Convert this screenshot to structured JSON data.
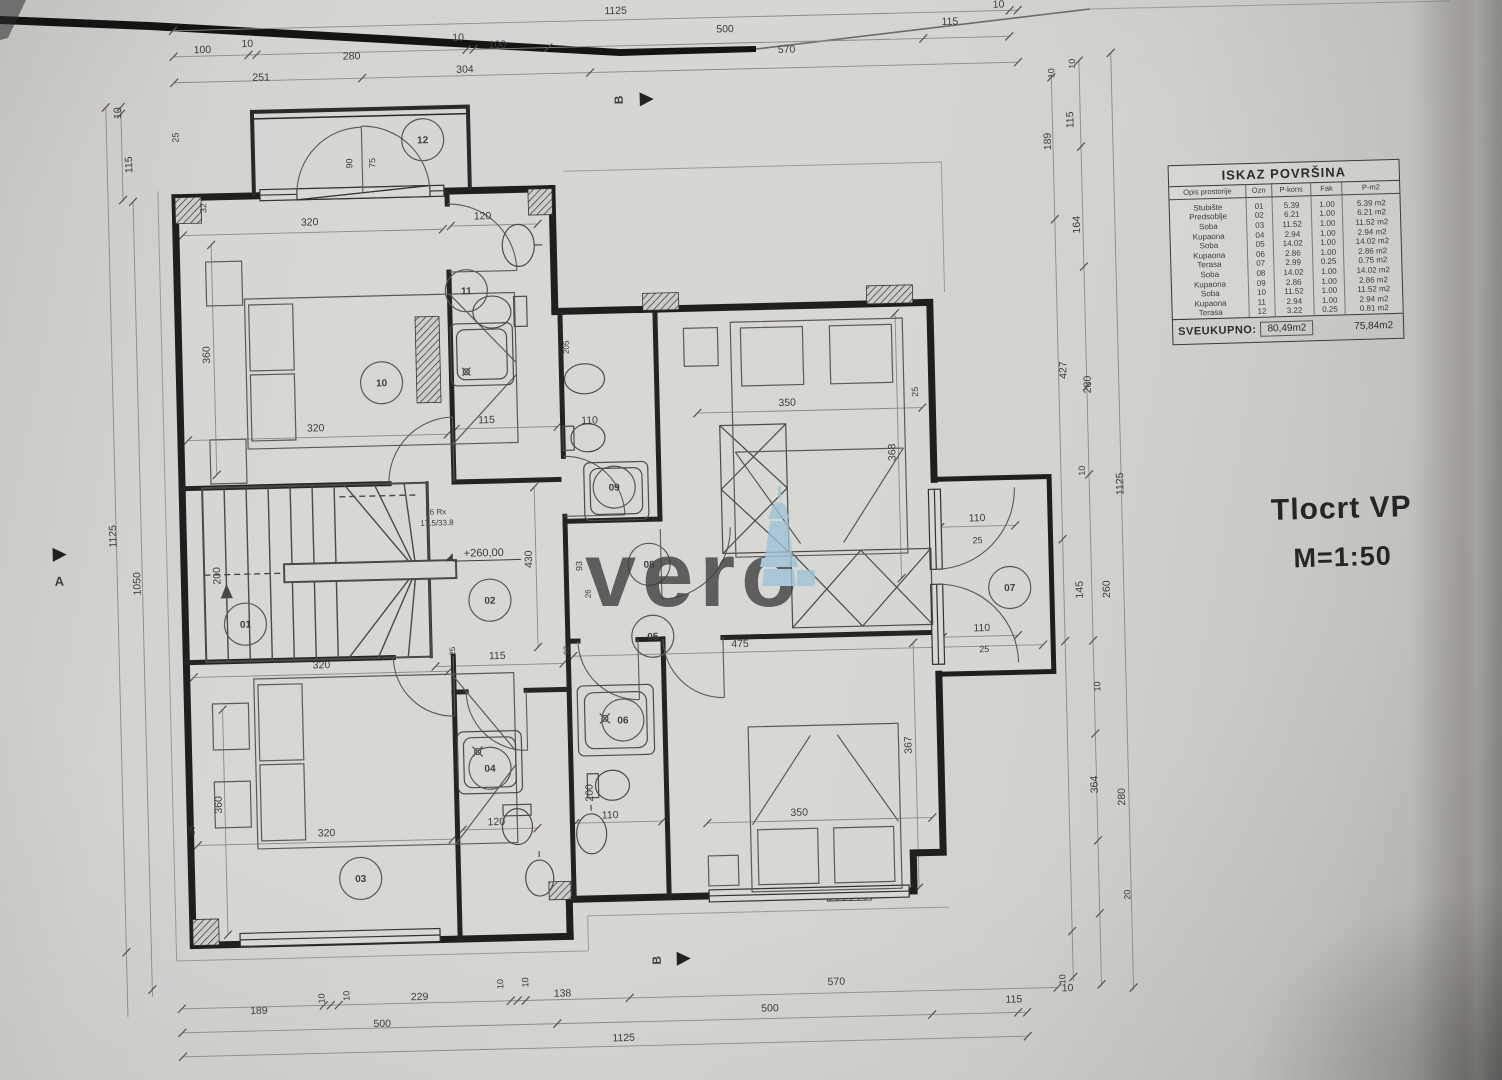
{
  "drawing": {
    "title": "Tlocrt VP",
    "scale": "M=1:50",
    "watermark": "vero"
  },
  "table": {
    "title": "ISKAZ POVRŠINA",
    "columns": [
      "Opis prostorije",
      "Ozn",
      "P-kons",
      "Fak",
      "P-m2"
    ],
    "rows": [
      [
        "Stubište",
        "01",
        "5.39",
        "1.00",
        "5.39 m2"
      ],
      [
        "Predsoblje",
        "02",
        "6.21",
        "1.00",
        "6.21 m2"
      ],
      [
        "Soba",
        "03",
        "11.52",
        "1.00",
        "11.52 m2"
      ],
      [
        "Kupaona",
        "04",
        "2.94",
        "1.00",
        "2.94 m2"
      ],
      [
        "Soba",
        "05",
        "14.02",
        "1.00",
        "14.02 m2"
      ],
      [
        "Kupaona",
        "06",
        "2.86",
        "1.00",
        "2.86 m2"
      ],
      [
        "Terasa",
        "07",
        "2.99",
        "0.25",
        "0.75 m2"
      ],
      [
        "Soba",
        "08",
        "14.02",
        "1.00",
        "14.02 m2"
      ],
      [
        "Kupaona",
        "09",
        "2.86",
        "1.00",
        "2.86 m2"
      ],
      [
        "Soba",
        "10",
        "11.52",
        "1.00",
        "11.52 m2"
      ],
      [
        "Kupaona",
        "11",
        "2.94",
        "1.00",
        "2.94 m2"
      ],
      [
        "Terasa",
        "12",
        "3.22",
        "0.25",
        "0.81 m2"
      ]
    ],
    "total_label": "SVEUKUPNO:",
    "total_kons": "80,49m2",
    "total_m2": "75,84m2"
  },
  "plan": {
    "rooms": [
      {
        "num": "01"
      },
      {
        "num": "02"
      },
      {
        "num": "03"
      },
      {
        "num": "04"
      },
      {
        "num": "05"
      },
      {
        "num": "06"
      },
      {
        "num": "07"
      },
      {
        "num": "08"
      },
      {
        "num": "09"
      },
      {
        "num": "10"
      },
      {
        "num": "11"
      },
      {
        "num": "12"
      }
    ],
    "dimension_labels": [
      "1125",
      "10",
      "100",
      "10",
      "280",
      "10",
      "100",
      "500",
      "115",
      "251",
      "304",
      "570",
      "189",
      "10",
      "10",
      "229",
      "10",
      "10",
      "138",
      "570",
      "500",
      "500",
      "115",
      "10",
      "1125",
      "10",
      "115",
      "1125",
      "1050",
      "32",
      "25",
      "10",
      "10",
      "115",
      "189",
      "164",
      "427",
      "280",
      "10",
      "1125",
      "145",
      "260",
      "10",
      "364",
      "280",
      "20",
      "10",
      "320",
      "120",
      "360",
      "320",
      "115",
      "110",
      "350",
      "368",
      "25",
      "205",
      "430",
      "200",
      "93",
      "26",
      "115",
      "475",
      "25",
      "92",
      "350",
      "367",
      "200",
      "110",
      "120",
      "320",
      "360",
      "320",
      "25",
      "110",
      "25",
      "110",
      "25",
      "90",
      "75"
    ],
    "annotations": {
      "stair_note_line1": "16 Rx",
      "stair_note_line2": "17.5/33.8",
      "level": "+260,00",
      "section_a": "A",
      "section_b": "B"
    }
  },
  "colors": {
    "watermark_blue": "#a2c8dc",
    "paper": "#d5d3d0",
    "wall": "#1f1f1f"
  }
}
